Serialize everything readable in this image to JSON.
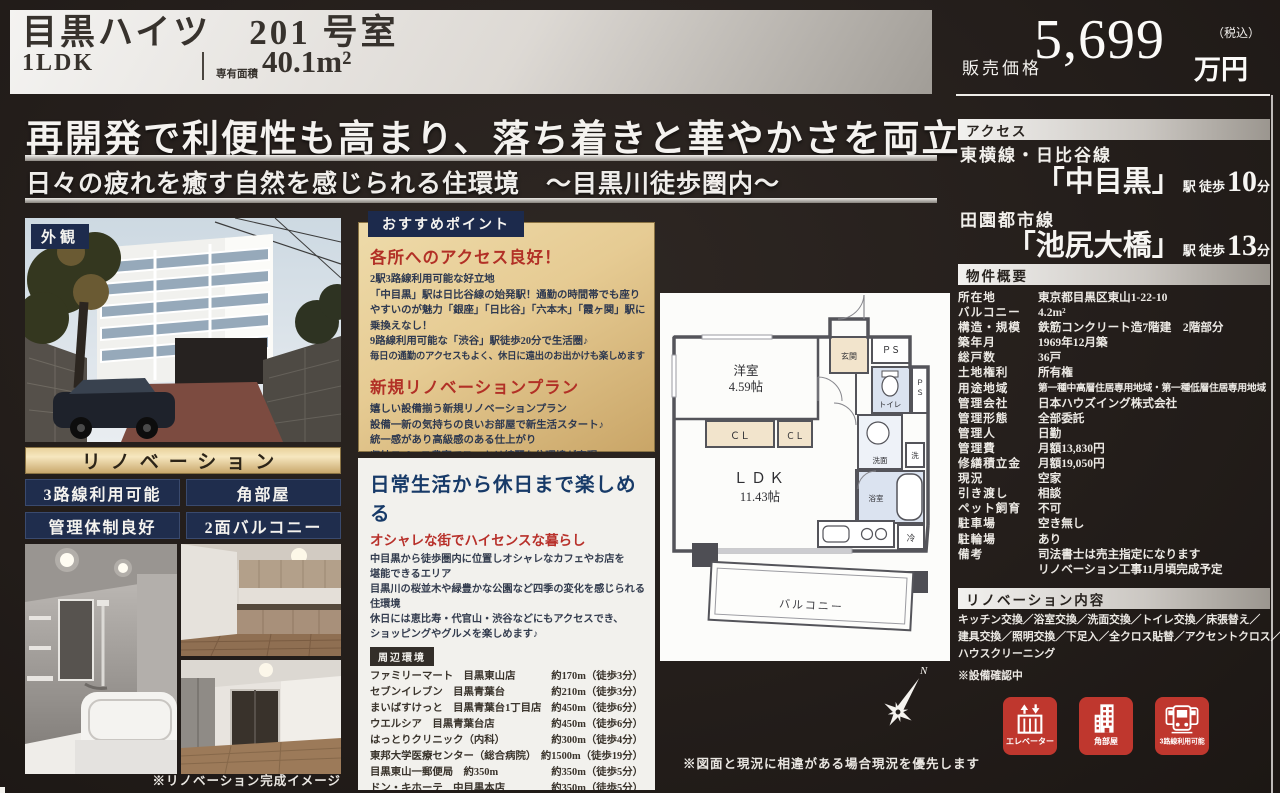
{
  "colors": {
    "navy": "#1e2c4e",
    "gold": "#dcbd83",
    "red_heading": "#b5312a",
    "icon_red": "#bf372e",
    "silver": "#d8d5d0"
  },
  "header": {
    "title": "目黒ハイツ　201 号室",
    "unit_type": "1LDK",
    "area_label": "専有面積",
    "area_value": "40.1m²",
    "price_label": "販売価格",
    "price_value": "5,699",
    "price_unit": "万円",
    "price_tax": "（税込）"
  },
  "catch": {
    "headline": "再開発で利便性も高まり、落ち着きと華やかさを両立",
    "subline": "日々の疲れを癒す自然を感じられる住環境　～目黒川徒歩圏内～"
  },
  "left": {
    "photo_tag": "外観",
    "renovation_banner": "リノベーション",
    "badges": [
      "3路線利用可能",
      "角部屋",
      "管理体制良好",
      "2面バルコニー"
    ],
    "photo_caption": "※リノベーション完成イメージ"
  },
  "points": {
    "tag": "おすすめポイント",
    "section1": {
      "heading": "各所へのアクセス良好！",
      "lines": [
        "2駅3路線利用可能な好立地",
        "「中目黒」駅は日比谷線の始発駅！通勤の時間帯でも座り",
        "やすいのが魅力「銀座」「日比谷」「六本木」「霞ヶ関」駅に",
        "乗換えなし！",
        "9路線利用可能な「渋谷」駅徒歩20分で生活圏♪",
        "毎日の通勤のアクセスもよく、休日に遠出のお出かけも楽しめます"
      ]
    },
    "section2": {
      "heading": "新規リノベーションプラン",
      "lines": [
        "嬉しい設備揃う新規リノベーションプラン",
        "設備一新の気持ちの良いお部屋で新生活スタート♪",
        "統一感があり高級感のある仕上がり",
        "収納スペース豊富でスッキリ綺麗な住環境が実現"
      ]
    }
  },
  "lifestyle": {
    "heading": "日常生活から休日まで楽しめる",
    "subheading": "オシャレな街でハイセンスな暮らし",
    "lines": [
      "中目黒から徒歩圏内に位置しオシャレなカフェやお店を",
      "堪能できるエリア",
      "目黒川の桜並木や緑豊かな公園など四季の変化を感じられる",
      "住環境",
      "休日には恵比寿・代官山・渋谷などにもアクセスでき、",
      "ショッピングやグルメを楽しめます♪"
    ],
    "nearby_tag": "周辺環境",
    "nearby": [
      {
        "name": "ファミリーマート　目黒東山店",
        "distance": "約170m（徒歩3分）"
      },
      {
        "name": "セブンイレブン　目黒青葉台",
        "distance": "約210m（徒歩3分）"
      },
      {
        "name": "まいばすけっと　目黒青葉台1丁目店",
        "distance": "約450m（徒歩6分）"
      },
      {
        "name": "ウエルシア　目黒青葉台店",
        "distance": "約450m（徒歩6分）"
      },
      {
        "name": "はっとりクリニック（内科）",
        "distance": "約300m（徒歩4分）"
      },
      {
        "name": "東邦大学医療センター（総合病院）",
        "distance": "約1500m（徒歩19分）"
      },
      {
        "name": "目黒東山一郵便局　約350m",
        "distance": "約350m（徒歩5分）"
      },
      {
        "name": "ドン・キホーテ　中目黒本店",
        "distance": "約350m（徒歩5分）"
      },
      {
        "name": "渋谷駅",
        "distance": "約1600m（徒歩20分）"
      },
      {
        "name": "渋谷マークシティ",
        "distance": "約1500m（徒歩19分）"
      }
    ]
  },
  "floorplan": {
    "rooms": {
      "western": "洋室",
      "western_size": "4.59帖",
      "entrance": "玄関",
      "ps1": "ＰＳ",
      "ps2_p": "Ｐ",
      "ps2_s": "Ｓ",
      "toilet": "トイレ",
      "cl1": "ＣＬ",
      "cl2": "ＣＬ",
      "wash": "洗面",
      "washer": "洗",
      "bath": "浴室",
      "ldk": "ＬＤＫ",
      "ldk_size": "11.43帖",
      "fridge": "冷",
      "balcony": "バルコニー"
    },
    "compass_label": "N",
    "caption": "※図面と現況に相違がある場合現況を優先します"
  },
  "access": {
    "header": "アクセス",
    "routes": [
      {
        "line": "東横線・日比谷線",
        "station": "「中目黒」",
        "walk": "駅 徒歩",
        "minutes": "10",
        "unit": "分"
      },
      {
        "line": "田園都市線",
        "station": "「池尻大橋」",
        "walk": "駅 徒歩",
        "minutes": "13",
        "unit": "分"
      }
    ]
  },
  "overview": {
    "header": "物件概要",
    "rows": [
      {
        "label": "所在地",
        "value": "東京都目黒区東山1-22-10"
      },
      {
        "label": "バルコニー",
        "value": "4.2m²"
      },
      {
        "label": "構造・規模",
        "value": "鉄筋コンクリート造7階建　2階部分"
      },
      {
        "label": "築年月",
        "value": "1969年12月築"
      },
      {
        "label": "総戸数",
        "value": "36戸"
      },
      {
        "label": "土地権利",
        "value": "所有権"
      },
      {
        "label": "用途地域",
        "value": "第一種中高層住居専用地域・第一種低層住居専用地域"
      },
      {
        "label": "管理会社",
        "value": "日本ハウズイング株式会社"
      },
      {
        "label": "管理形態",
        "value": "全部委託"
      },
      {
        "label": "管理人",
        "value": "日勤"
      },
      {
        "label": "管理費",
        "value": "月額13,830円"
      },
      {
        "label": "修繕積立金",
        "value": "月額19,050円"
      },
      {
        "label": "現況",
        "value": "空家"
      },
      {
        "label": "引き渡し",
        "value": "相談"
      },
      {
        "label": "ペット飼育",
        "value": "不可"
      },
      {
        "label": "駐車場",
        "value": "空き無し"
      },
      {
        "label": "駐輪場",
        "value": "あり"
      },
      {
        "label": "備考",
        "value": "司法書士は売主指定になります\nリノベーション工事11月頃完成予定"
      }
    ]
  },
  "renovation": {
    "header": "リノベーション内容",
    "lines": [
      "キッチン交換／浴室交換／洗面交換／トイレ交換／床張替え／",
      "建具交換／照明交換／下足入／全クロス貼替／アクセントクロス／",
      "ハウスクリーニング",
      "※設備確認中"
    ]
  },
  "features": [
    {
      "label": "エレベーター",
      "icon": "elevator-icon"
    },
    {
      "label": "角部屋",
      "icon": "corner-building-icon"
    },
    {
      "label": "3路線利用可能",
      "icon": "train-lines-icon"
    }
  ]
}
